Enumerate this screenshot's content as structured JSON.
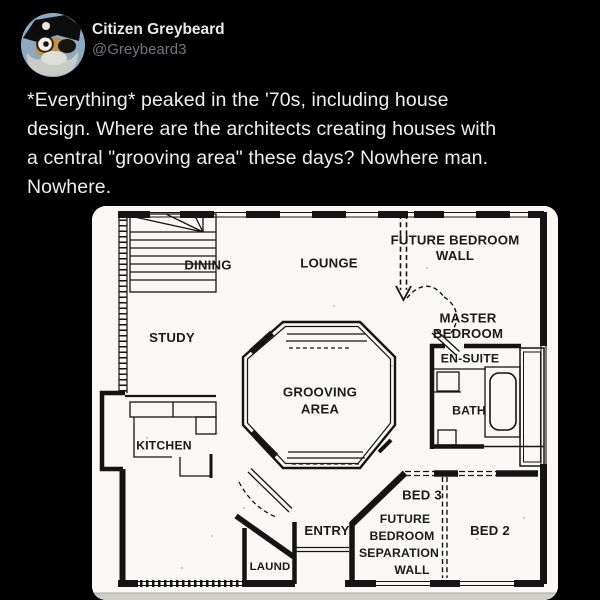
{
  "tweet": {
    "author": {
      "name": "Citizen Greybeard",
      "handle": "@Greybeard3"
    },
    "body_lines": [
      "*Everything* peaked in the '70s, including house",
      "design. Where are the architects creating houses with",
      "a central \"grooving area\" these days? Nowhere man.",
      "Nowhere."
    ]
  },
  "floorplan": {
    "labels": {
      "dining": "DINING",
      "lounge": "LOUNGE",
      "future_bedroom_wall_line1": "FUTURE BEDROOM",
      "future_bedroom_wall_line2": "WALL",
      "study": "STUDY",
      "master_bedroom_line1": "MASTER",
      "master_bedroom_line2": "BEDROOM",
      "en_suite": "EN-SUITE",
      "grooving_area_line1": "GROOVING",
      "grooving_area_line2": "AREA",
      "bath": "BATH",
      "kitchen": "KITCHEN",
      "bed3": "BED 3",
      "separation_line1": "FUTURE",
      "separation_line2": "BEDROOM",
      "separation_line3": "SEPARATION",
      "separation_line4": "WALL",
      "bed2": "BED 2",
      "entry": "ENTRY",
      "laundry": "LAUND"
    }
  },
  "colors": {
    "page_background": "#000000",
    "text_primary": "#e7e9ea",
    "text_secondary": "#71767b",
    "plan_paper": "#f9f8f4",
    "plan_ink": "#141414"
  }
}
